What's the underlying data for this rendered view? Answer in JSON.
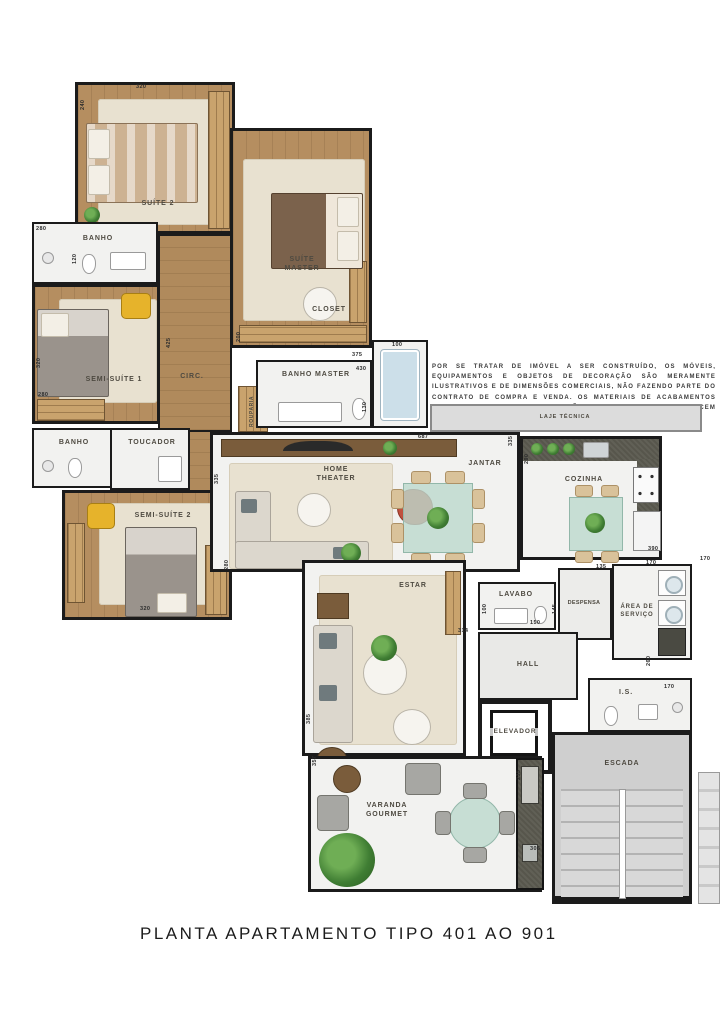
{
  "title": "PLANTA APARTAMENTO TIPO 401 AO 901",
  "disclaimer": {
    "lines": [
      "POR SE TRATAR DE IMÓVEL A SER CONSTRUÍDO, OS MÓVEIS, EQUIPAMENTOS E OBJETOS DE",
      "DECORAÇÃO SÃO MERAMENTE ILUSTRATIVOS E DE DIMENSÕES COMERCIAIS, NÃO FAZENDO",
      "PARTE DO CONTRATO DE COMPRA E VENDA. OS MATERIAIS DE ACABAMENTOS CONSTANTES",
      "DAS ESPECIFICAÇÕES CONTRATUAIS PREVALECEM SOBRE ESTAS ILUSTRAÇÕES."
    ]
  },
  "rooms": {
    "suite_2": "SUÍTE 2",
    "suite_master": "SUÍTE MASTER",
    "closet": "CLOSET",
    "banho_1": "BANHO",
    "semi_suite_1": "SEMI-SUÍTE 1",
    "circ": "CIRC.",
    "rouparia": "ROUPARIA",
    "banho_master": "BANHO MASTER",
    "banho_2": "BANHO",
    "toucador": "TOUCADOR",
    "semi_suite_2": "SEMI-SUÍTE 2",
    "laje_tecnica": "LAJE TÉCNICA",
    "home_theater": "HOME THEATER",
    "jantar": "JANTAR",
    "cozinha": "COZINHA",
    "lavabo": "LAVABO",
    "despensa": "DESPENSA",
    "area_servico": "ÁREA DE SERVIÇO",
    "estar": "ESTAR",
    "hall": "HALL",
    "elevador": "ELEVADOR",
    "is": "I.S.",
    "escada": "ESCADA",
    "varanda_gourmet": "VARANDA GOURMET"
  },
  "dimensions": [
    {
      "t": "320",
      "x": 136,
      "y": 84,
      "v": false
    },
    {
      "t": "240",
      "x": 80,
      "y": 110,
      "v": true
    },
    {
      "t": "280",
      "x": 36,
      "y": 226,
      "v": false
    },
    {
      "t": "120",
      "x": 72,
      "y": 264,
      "v": true
    },
    {
      "t": "320",
      "x": 36,
      "y": 368,
      "v": true
    },
    {
      "t": "280",
      "x": 38,
      "y": 392,
      "v": false
    },
    {
      "t": "425",
      "x": 166,
      "y": 348,
      "v": true
    },
    {
      "t": "200",
      "x": 236,
      "y": 342,
      "v": true
    },
    {
      "t": "375",
      "x": 352,
      "y": 352,
      "v": false
    },
    {
      "t": "100",
      "x": 392,
      "y": 342,
      "v": false
    },
    {
      "t": "430",
      "x": 356,
      "y": 366,
      "v": false
    },
    {
      "t": "130",
      "x": 362,
      "y": 412,
      "v": true
    },
    {
      "t": "687",
      "x": 418,
      "y": 434,
      "v": false
    },
    {
      "t": "335",
      "x": 508,
      "y": 446,
      "v": true
    },
    {
      "t": "335",
      "x": 214,
      "y": 484,
      "v": true
    },
    {
      "t": "290",
      "x": 524,
      "y": 464,
      "v": true
    },
    {
      "t": "390",
      "x": 648,
      "y": 546,
      "v": false
    },
    {
      "t": "135",
      "x": 596,
      "y": 564,
      "v": false
    },
    {
      "t": "170",
      "x": 646,
      "y": 560,
      "v": false
    },
    {
      "t": "170",
      "x": 700,
      "y": 556,
      "v": false
    },
    {
      "t": "100",
      "x": 482,
      "y": 614,
      "v": true
    },
    {
      "t": "150",
      "x": 530,
      "y": 620,
      "v": false
    },
    {
      "t": "145",
      "x": 552,
      "y": 614,
      "v": true
    },
    {
      "t": "314",
      "x": 458,
      "y": 628,
      "v": false
    },
    {
      "t": "260",
      "x": 646,
      "y": 666,
      "v": true
    },
    {
      "t": "170",
      "x": 664,
      "y": 684,
      "v": false
    },
    {
      "t": "320",
      "x": 140,
      "y": 606,
      "v": false
    },
    {
      "t": "280",
      "x": 224,
      "y": 570,
      "v": true
    },
    {
      "t": "385",
      "x": 306,
      "y": 724,
      "v": true
    },
    {
      "t": "357",
      "x": 312,
      "y": 766,
      "v": true
    },
    {
      "t": "235",
      "x": 516,
      "y": 780,
      "v": true
    },
    {
      "t": "306",
      "x": 530,
      "y": 846,
      "v": false
    }
  ],
  "colors": {
    "wall": "#1b1b1b",
    "wood": "#b58e60",
    "carpet": "#e8e1d0",
    "tile": "#f2f2f0",
    "counter_dark": "#57564c",
    "stair_gray": "#cfcfcf",
    "accent_yellow": "#e6b32b",
    "accent_red": "#c0503e",
    "plant_green": "#3f7d33",
    "glass_teal": "#bcd8cd",
    "tub_blue": "#ccdfe9"
  }
}
